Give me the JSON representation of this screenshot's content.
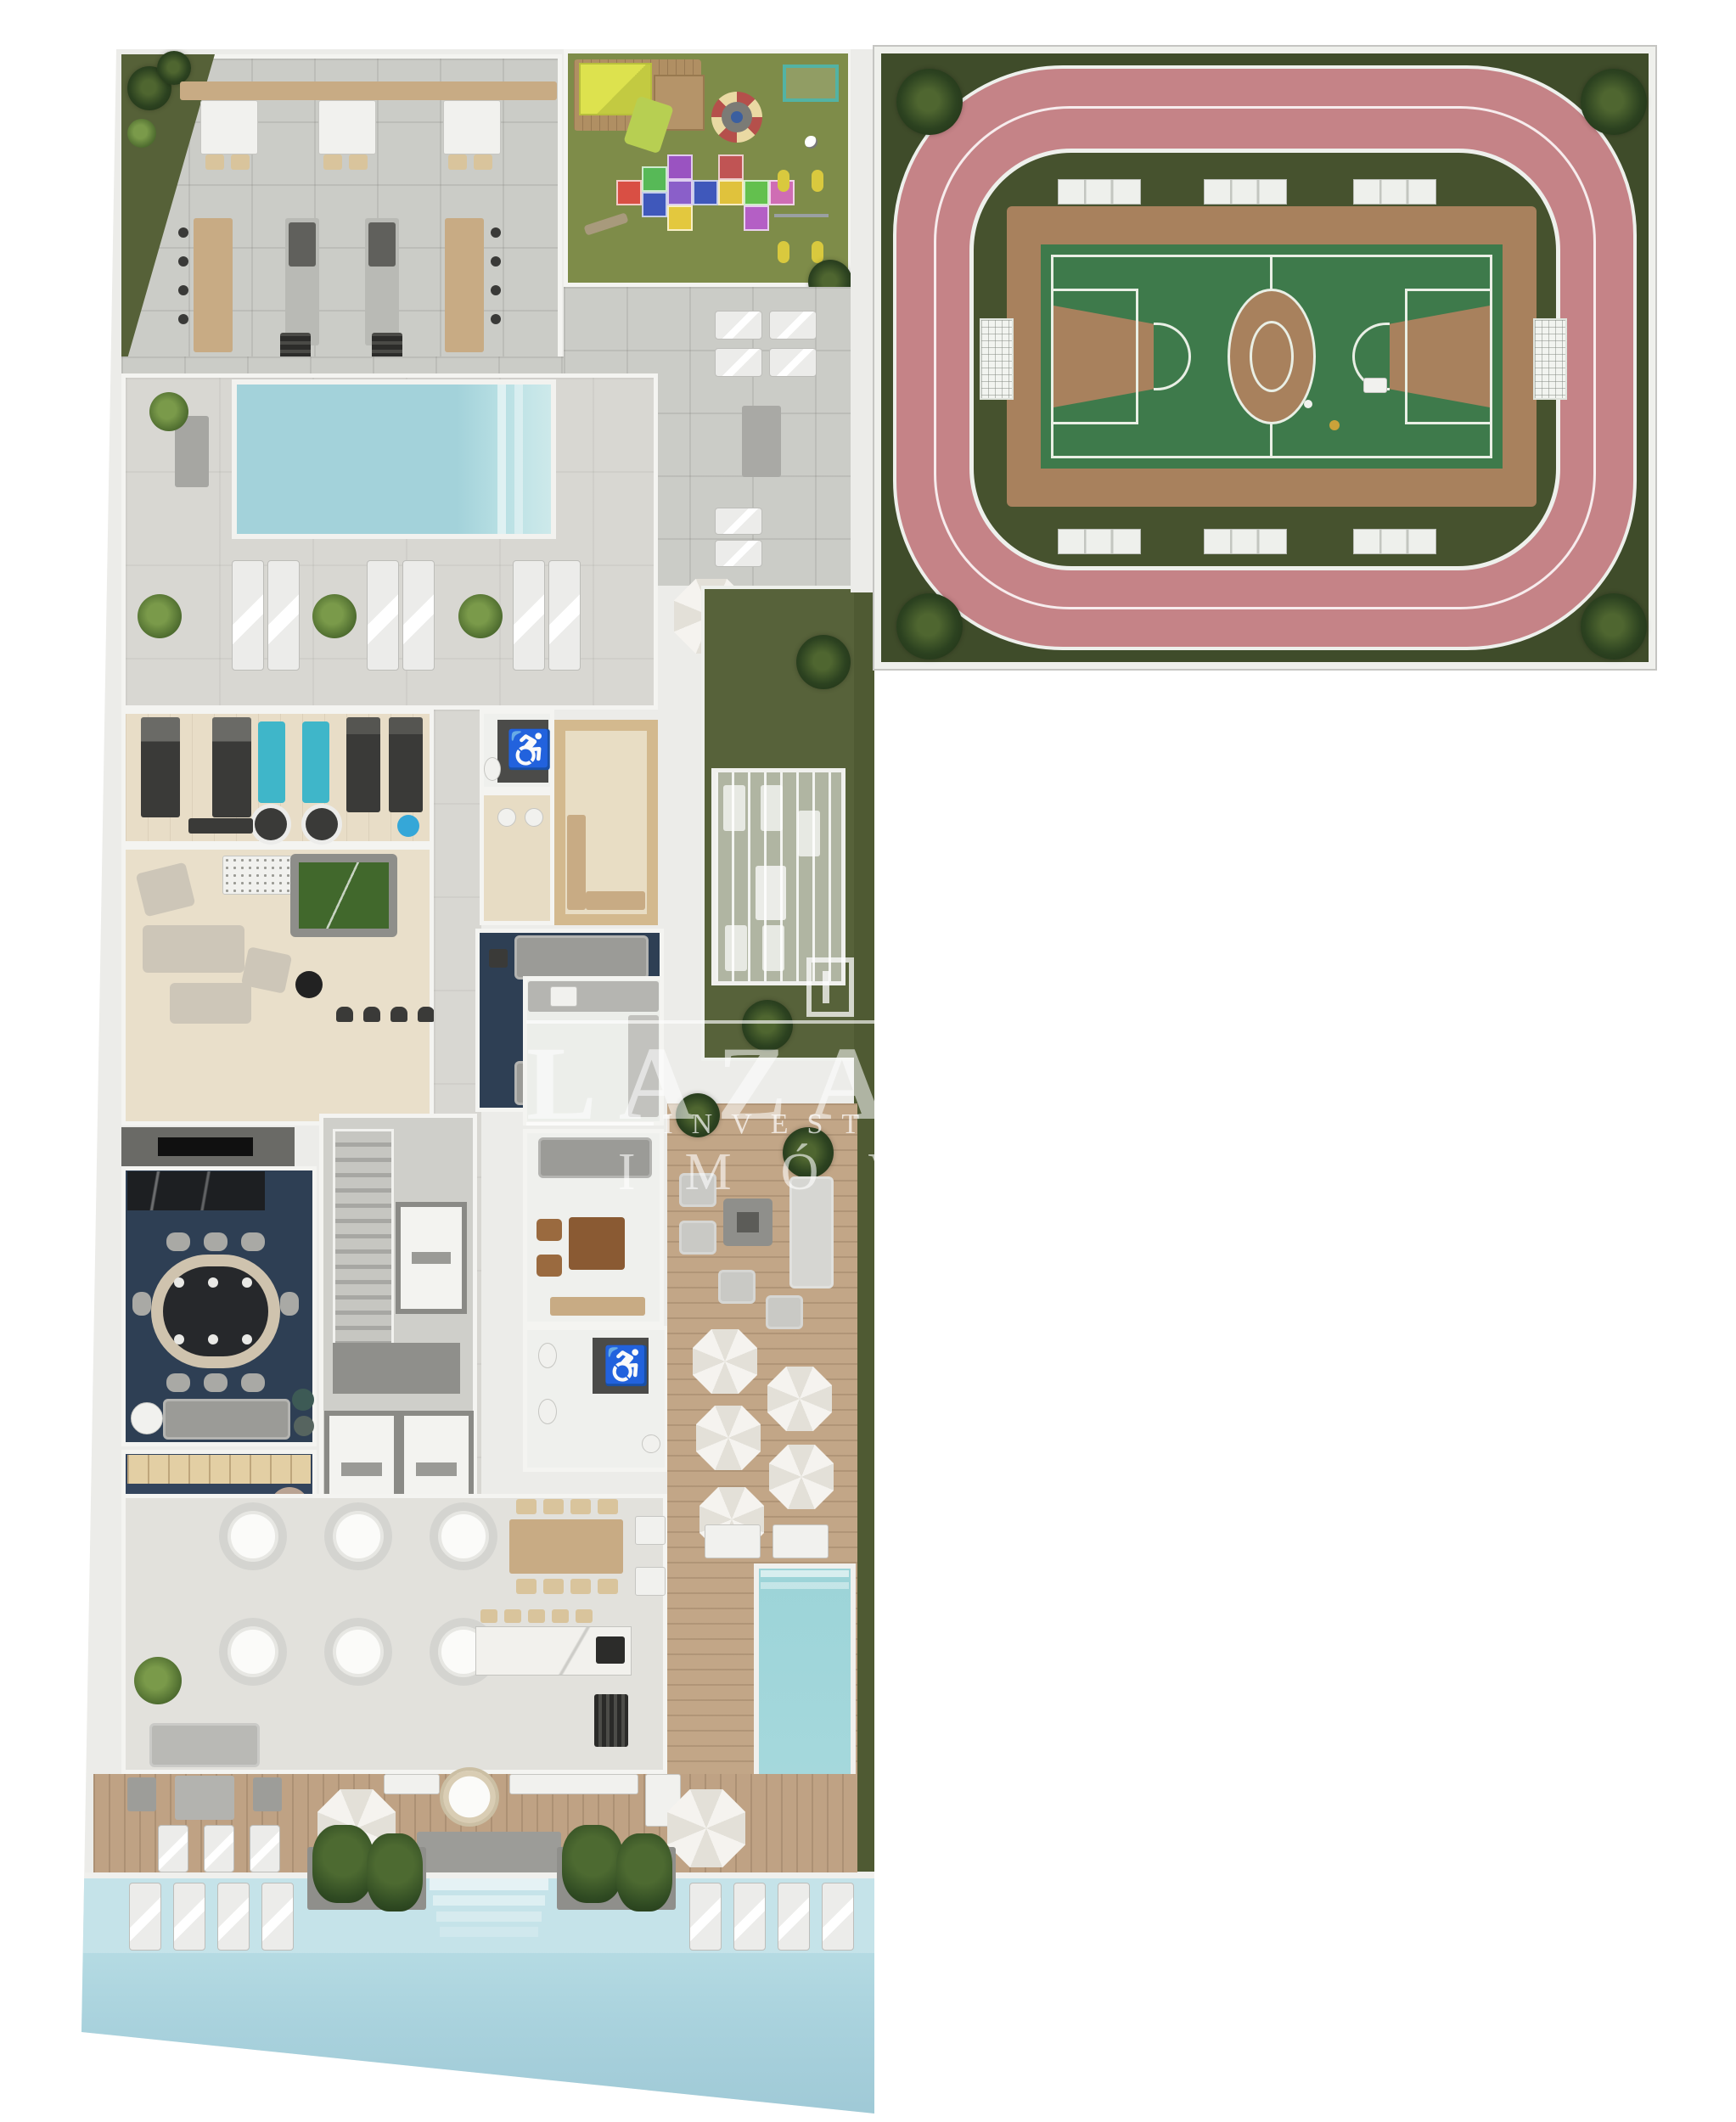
{
  "watermark": {
    "logo_icon": "square-frame-logo",
    "brand": "LAZAROTTO",
    "line2": "INVESTIMENTOS",
    "line3": "IMÓVEIS"
  },
  "icons": {
    "wheelchair": "♿"
  },
  "palette": {
    "background": "#ffffff",
    "wall": "#ecece9",
    "tile_floor": "#cbccc7",
    "deck_floor": "#d8d7d2",
    "wood_deck": "#bfa284",
    "wood_floor": "#e8ddc7",
    "navy_floor": "#2e3f54",
    "pool_water": "#a7d4dc",
    "lawn_green": "#57623a",
    "playground_grass": "#7e8c49",
    "track_pink": "#c58387",
    "court_green": "#3e7a4b",
    "court_clay": "#a8815d",
    "gym_mat_blue": "#3fb6c9",
    "accent_yellow": "#c3d13c"
  },
  "regions": [
    "running-track",
    "sports-court",
    "playground",
    "barbecue-terrace",
    "lap-pool",
    "sun-deck",
    "gym",
    "games-room",
    "sauna",
    "accessible-restroom",
    "tv-lounge",
    "gourmet-dining-room",
    "kids-playroom",
    "stair-core",
    "elevators",
    "reading-lounge",
    "restrooms",
    "pergola-spa",
    "party-room",
    "outdoor-lounge-deck",
    "umbrella-deck",
    "jacuzzi-pool",
    "main-pool"
  ]
}
